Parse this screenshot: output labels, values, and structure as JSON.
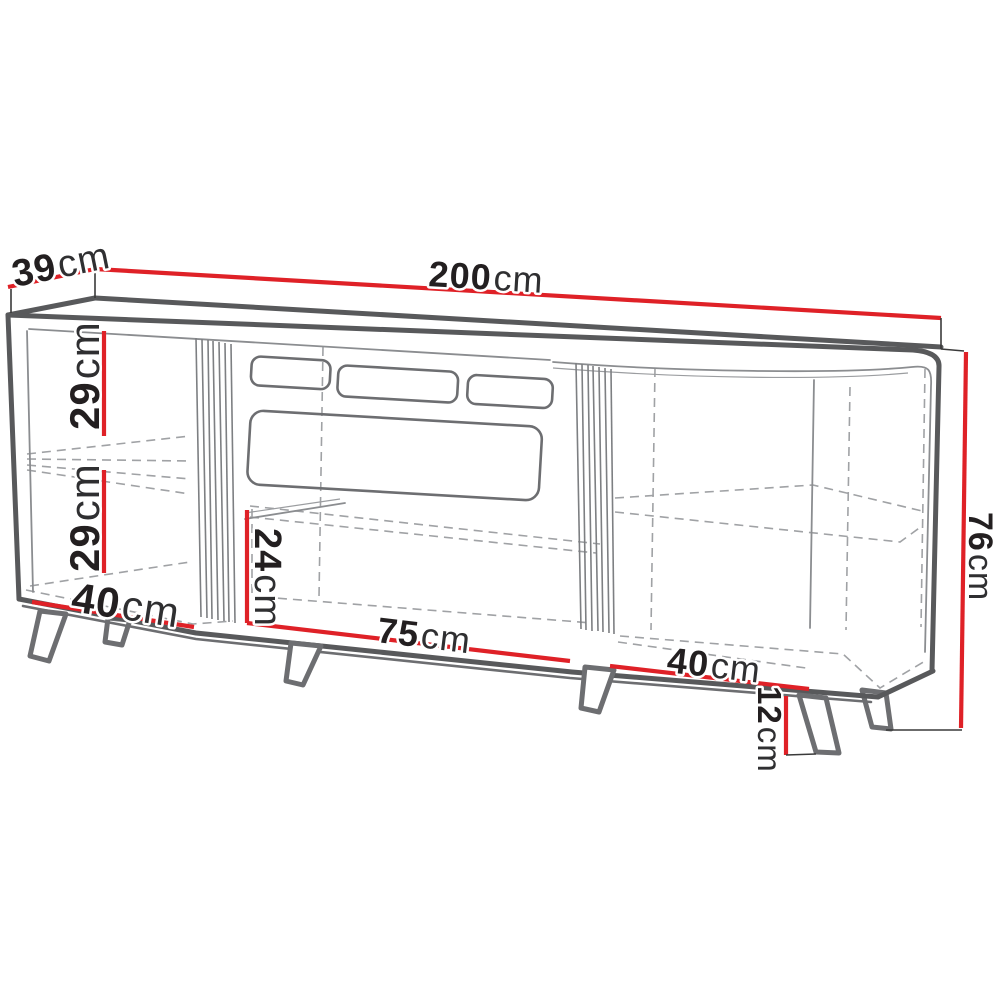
{
  "page": {
    "description": "Technical dimension drawing of a 200 cm sideboard / TV cabinet with two slatted doors, open shelf compartments and splayed legs",
    "background": "#ffffff"
  },
  "unit": "cm",
  "dimensions": {
    "total_width": {
      "value": "200",
      "unit": "cm"
    },
    "total_depth": {
      "value": "39",
      "unit": "cm"
    },
    "total_height": {
      "value": "76",
      "unit": "cm"
    },
    "left_upper_compartment_height": {
      "value": "29",
      "unit": "cm"
    },
    "left_lower_compartment_height": {
      "value": "29",
      "unit": "cm"
    },
    "left_compartment_width": {
      "value": "40",
      "unit": "cm"
    },
    "center_compartment_height": {
      "value": "24",
      "unit": "cm"
    },
    "center_compartment_width": {
      "value": "75",
      "unit": "cm"
    },
    "right_compartment_width": {
      "value": "40",
      "unit": "cm"
    },
    "leg_height": {
      "value": "12",
      "unit": "cm"
    }
  },
  "colors": {
    "dimension_line": "#df2127",
    "outline_dark": "#58595b",
    "outline_medium": "#6d6e71",
    "thin_line": "#8b8d90",
    "dashed_line": "#a0a2a5",
    "label_text": "#231f20"
  }
}
